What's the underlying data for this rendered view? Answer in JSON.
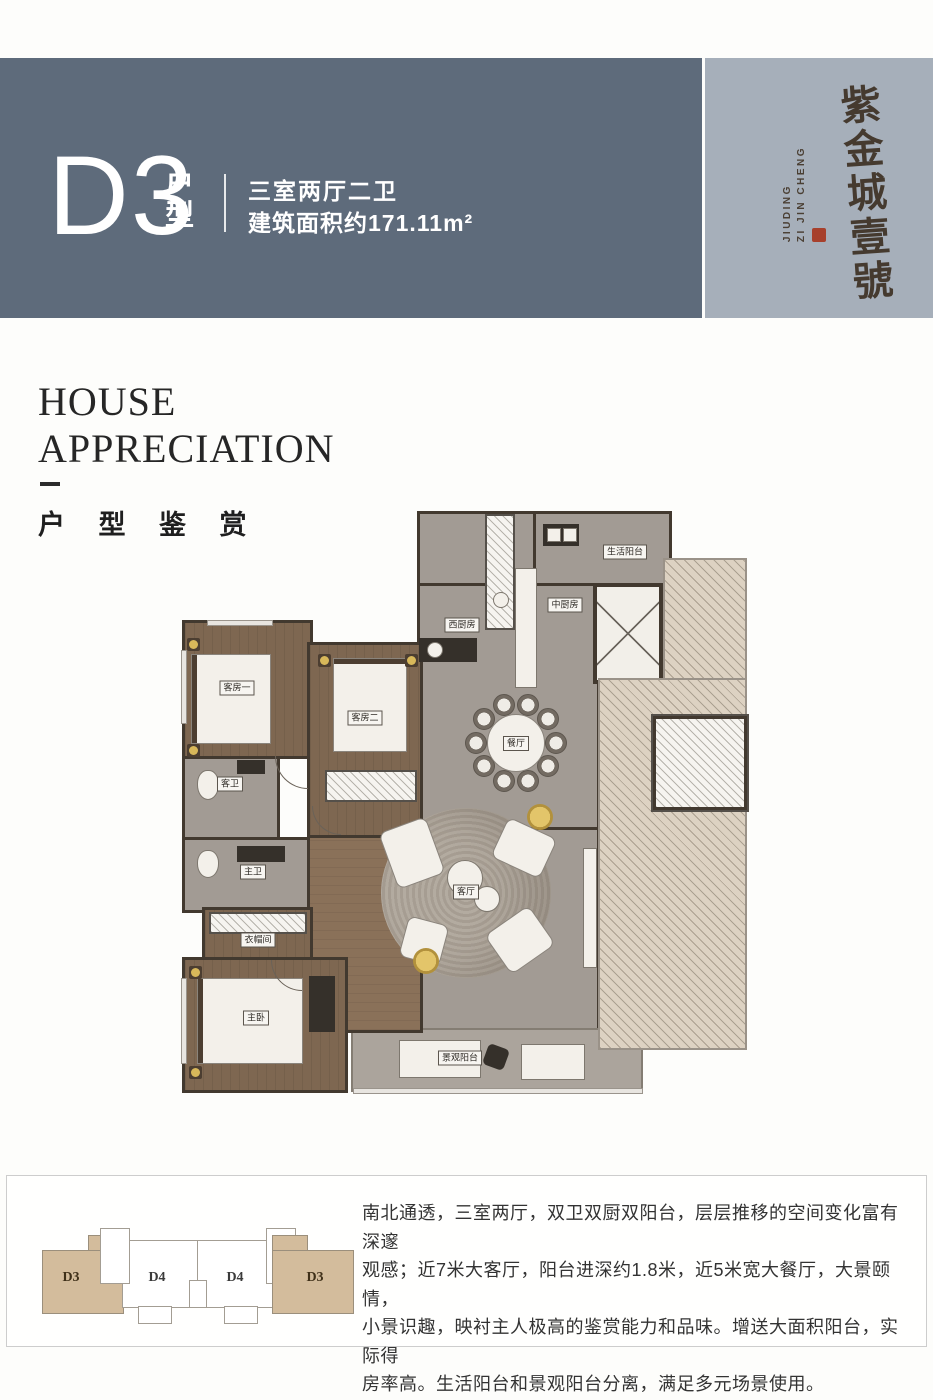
{
  "page": {
    "background": "#fdfdfb"
  },
  "header": {
    "unit_code": "D3",
    "unit_type_chars": [
      "户",
      "型"
    ],
    "spec": "三室两厅二卫",
    "area": "建筑面积约171.11m²",
    "colors": {
      "band_dark": "#5e6b7b",
      "band_light": "#a6afba"
    },
    "logo": {
      "name": "紫金城壹號",
      "latin_line1": "JIUDING",
      "latin_line2": "ZI JIN CHENG",
      "seal_color": "#a7402c",
      "ink_color": "#453a2f"
    }
  },
  "section_title": {
    "en_line1": "HOUSE",
    "en_line2": "APPRECIATION",
    "cn": "户 型 鉴 赏"
  },
  "floorplan": {
    "labels": {
      "life_balcony": "生活阳台",
      "chinese_kitchen": "中厨房",
      "west_kitchen": "西厨房",
      "guest_room_1": "客房一",
      "guest_room_2": "客房二",
      "dining_room": "餐厅",
      "guest_bath": "客卫",
      "master_bath": "主卫",
      "cloakroom": "衣帽间",
      "living_room": "客厅",
      "master_bedroom": "主卧",
      "view_balcony": "景观阳台"
    }
  },
  "footer": {
    "plate_units": [
      "D3",
      "D4",
      "D4",
      "D3"
    ],
    "highlight_color": "#d3bc9c",
    "description_lines": [
      "南北通透，三室两厅，双卫双厨双阳台，层层推移的空间变化富有深邃",
      "观感；近7米大客厅，阳台进深约1.8米，近5米宽大餐厅，大景颐情，",
      "小景识趣，映衬主人极高的鉴赏能力和品味。增送大面积阳台，实际得",
      "房率高。生活阳台和景观阳台分离，满足多元场景使用。"
    ]
  }
}
